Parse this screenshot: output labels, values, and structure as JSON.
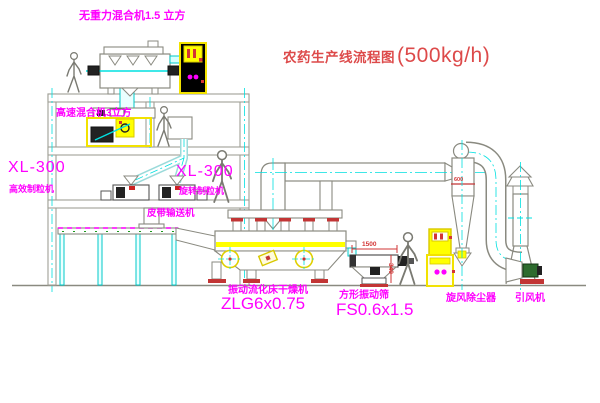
{
  "title": {
    "name": "农药生产线流程图",
    "capacity": "(500kg/h)"
  },
  "labels": {
    "top_mixer": "无重力混合机1.5 立方",
    "mid_mixer": "高速混合机3立方",
    "granulator_left_model": "XL-300",
    "granulator_left_name": "高效制粒机",
    "granulator_right_model": "XL-300",
    "granulator_right_name": "旋转制粒机",
    "belt_conveyor": "皮带输送机",
    "dryer_name": "振动流化床干燥机",
    "dryer_model": "ZLG6x0.75",
    "sieve_name": "方形振动筛",
    "sieve_model": "FS0.6x1.5",
    "cyclone": "旋风除尘器",
    "fan": "引风机"
  },
  "dimensions": {
    "sieve_length": "1500",
    "sieve_height": "340",
    "cyclone_dia": "600"
  },
  "colors": {
    "label_magenta": "#ff00ff",
    "title_red": "#dd4a4a",
    "dimension_red": "#d23535",
    "centerline_cyan": "#00e0e0",
    "highlight_yellow": "#ffff00",
    "cad_line_grey": "#a0a096"
  }
}
